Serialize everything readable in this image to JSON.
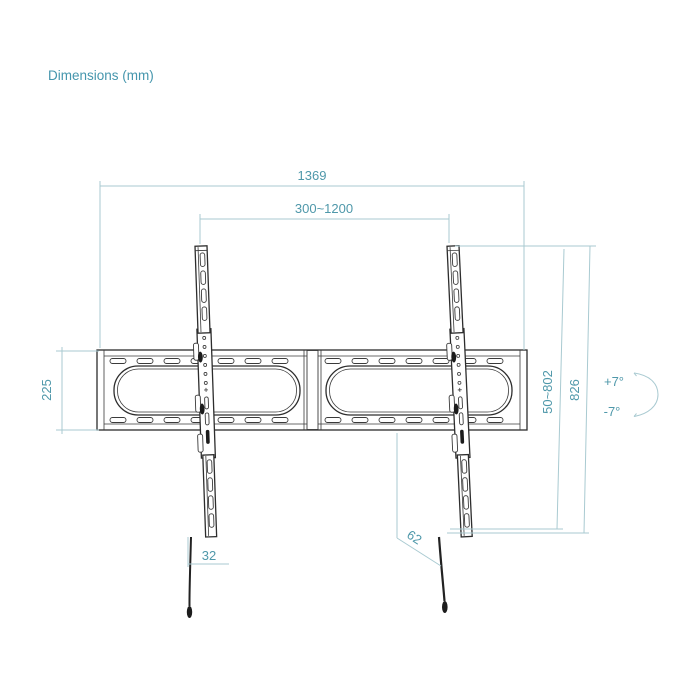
{
  "title": "Dimensions (mm)",
  "colors": {
    "accent_text": "#4f98aa",
    "dimension_line": "#a9cad1",
    "drawing_line": "#2d2d2d",
    "background": "#ffffff"
  },
  "dimensions": {
    "overall_width": "1369",
    "mount_width_range": "300~1200",
    "rail_height": "225",
    "mount_height_range": "50~802",
    "overall_height": "826",
    "tilt_up": "+7°",
    "tilt_down": "-7°",
    "string_offset": "32",
    "depth": "62"
  }
}
